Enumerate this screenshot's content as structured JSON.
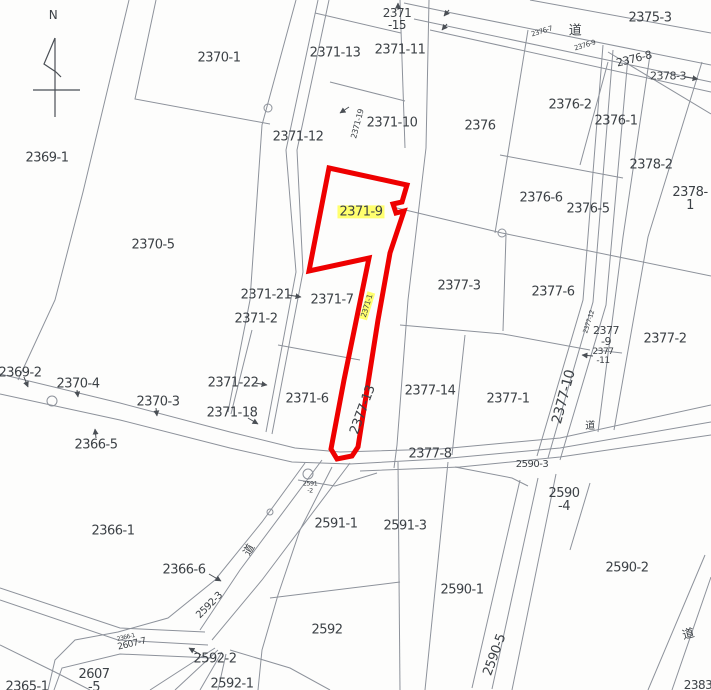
{
  "map": {
    "type": "cadastral-parcel-map",
    "selected_parcel": {
      "id": "2371-9",
      "outline_color": "#ee0000",
      "highlight_color": "#ffff6e"
    },
    "road_kanji": "道",
    "labels": [
      {
        "text": "N",
        "x": 53,
        "y": 15,
        "size": 12,
        "name": "compass-n-label"
      },
      {
        "text": "2369-1",
        "x": 47,
        "y": 158
      },
      {
        "text": "2370-1",
        "x": 219,
        "y": 58
      },
      {
        "text": "2371-13",
        "x": 335,
        "y": 53
      },
      {
        "text": "2371\n-15",
        "x": 397,
        "y": 19,
        "size": 12
      },
      {
        "text": "2371-11",
        "x": 400,
        "y": 50
      },
      {
        "text": "2375-3",
        "x": 650,
        "y": 18
      },
      {
        "text": "道",
        "x": 575,
        "y": 31,
        "name": "road-label"
      },
      {
        "text": "2376-7",
        "x": 542,
        "y": 32,
        "size": 7,
        "rot": -17
      },
      {
        "text": "2376-9",
        "x": 585,
        "y": 46,
        "size": 7,
        "rot": -17
      },
      {
        "text": "2376-8",
        "x": 634,
        "y": 59,
        "size": 11,
        "rot": -14
      },
      {
        "text": "2378-3",
        "x": 668,
        "y": 76,
        "size": 11
      },
      {
        "text": "2376-2",
        "x": 570,
        "y": 105
      },
      {
        "text": "2376-1",
        "x": 616,
        "y": 121
      },
      {
        "text": "2378-2",
        "x": 651,
        "y": 165
      },
      {
        "text": "2378-1",
        "x": 690,
        "y": 199
      },
      {
        "text": "2371-12",
        "x": 298,
        "y": 137
      },
      {
        "text": "2371-19",
        "x": 358,
        "y": 124,
        "size": 8,
        "rot": -75
      },
      {
        "text": "2371-10",
        "x": 392,
        "y": 123
      },
      {
        "text": "2376",
        "x": 480,
        "y": 126
      },
      {
        "text": "2376-6",
        "x": 541,
        "y": 198
      },
      {
        "text": "2376-5",
        "x": 588,
        "y": 209
      },
      {
        "text": "2370-5",
        "x": 153,
        "y": 245
      },
      {
        "text": "2371-9",
        "x": 361,
        "y": 212,
        "hl": true,
        "name": "selected-parcel-label"
      },
      {
        "text": "2371-21",
        "x": 266,
        "y": 295
      },
      {
        "text": "2371-7",
        "x": 332,
        "y": 300
      },
      {
        "text": "2371-2",
        "x": 256,
        "y": 319
      },
      {
        "text": "2371-1",
        "x": 367,
        "y": 306,
        "size": 7.5,
        "rot": -73,
        "hl": true
      },
      {
        "text": "2377-3",
        "x": 459,
        "y": 286
      },
      {
        "text": "2377-6",
        "x": 553,
        "y": 292
      },
      {
        "text": "2377\n-9",
        "x": 606,
        "y": 336,
        "size": 11
      },
      {
        "text": "2377-2",
        "x": 665,
        "y": 339
      },
      {
        "text": "2377-12",
        "x": 589,
        "y": 322,
        "size": 6.5,
        "rot": -72
      },
      {
        "text": "2377\n-11",
        "x": 603,
        "y": 357,
        "size": 9
      },
      {
        "text": "2369-2",
        "x": 20,
        "y": 373
      },
      {
        "text": "2370-4",
        "x": 78,
        "y": 384
      },
      {
        "text": "2370-3",
        "x": 158,
        "y": 402
      },
      {
        "text": "2371-22",
        "x": 233,
        "y": 383
      },
      {
        "text": "2371-18",
        "x": 232,
        "y": 413
      },
      {
        "text": "2371-6",
        "x": 307,
        "y": 399
      },
      {
        "text": "2377-14",
        "x": 430,
        "y": 391
      },
      {
        "text": "2377-1",
        "x": 508,
        "y": 399
      },
      {
        "text": "2377-10",
        "x": 564,
        "y": 397,
        "size": 14,
        "rot": -75
      },
      {
        "text": "2377-13",
        "x": 363,
        "y": 410,
        "rot": -70
      },
      {
        "text": "道",
        "x": 590,
        "y": 427,
        "size": 10,
        "name": "road-label"
      },
      {
        "text": "2366-5",
        "x": 96,
        "y": 445
      },
      {
        "text": "2377-8",
        "x": 430,
        "y": 454
      },
      {
        "text": "2590-3",
        "x": 532,
        "y": 465,
        "size": 10
      },
      {
        "text": "2590\n-4",
        "x": 564,
        "y": 500
      },
      {
        "text": "2591\n-2",
        "x": 310,
        "y": 487,
        "size": 6.5
      },
      {
        "text": "2366-1",
        "x": 113,
        "y": 531
      },
      {
        "text": "2591-1",
        "x": 336,
        "y": 524
      },
      {
        "text": "2591-3",
        "x": 405,
        "y": 526
      },
      {
        "text": "2590-1",
        "x": 462,
        "y": 590
      },
      {
        "text": "2590-2",
        "x": 627,
        "y": 568
      },
      {
        "text": "2366-6",
        "x": 184,
        "y": 570
      },
      {
        "text": "道",
        "x": 249,
        "y": 550,
        "size": 11,
        "rot": -60,
        "name": "road-label"
      },
      {
        "text": "2592-3",
        "x": 210,
        "y": 606,
        "size": 10,
        "rot": -45
      },
      {
        "text": "2590-5",
        "x": 495,
        "y": 655,
        "rot": -70
      },
      {
        "text": "2592",
        "x": 327,
        "y": 630
      },
      {
        "text": "道",
        "x": 688,
        "y": 634,
        "size": 12,
        "rot": -15,
        "name": "road-label"
      },
      {
        "text": "2366-1",
        "x": 126,
        "y": 638,
        "size": 6,
        "rot": -13
      },
      {
        "text": "2607-7",
        "x": 132,
        "y": 645,
        "size": 9,
        "rot": -13
      },
      {
        "text": "2592-2",
        "x": 215,
        "y": 659
      },
      {
        "text": "2607\n-5",
        "x": 94,
        "y": 681
      },
      {
        "text": "2365-1",
        "x": 27,
        "y": 687
      },
      {
        "text": "2592-1",
        "x": 232,
        "y": 684
      },
      {
        "text": "2383",
        "x": 698,
        "y": 685,
        "size": 12
      }
    ]
  }
}
